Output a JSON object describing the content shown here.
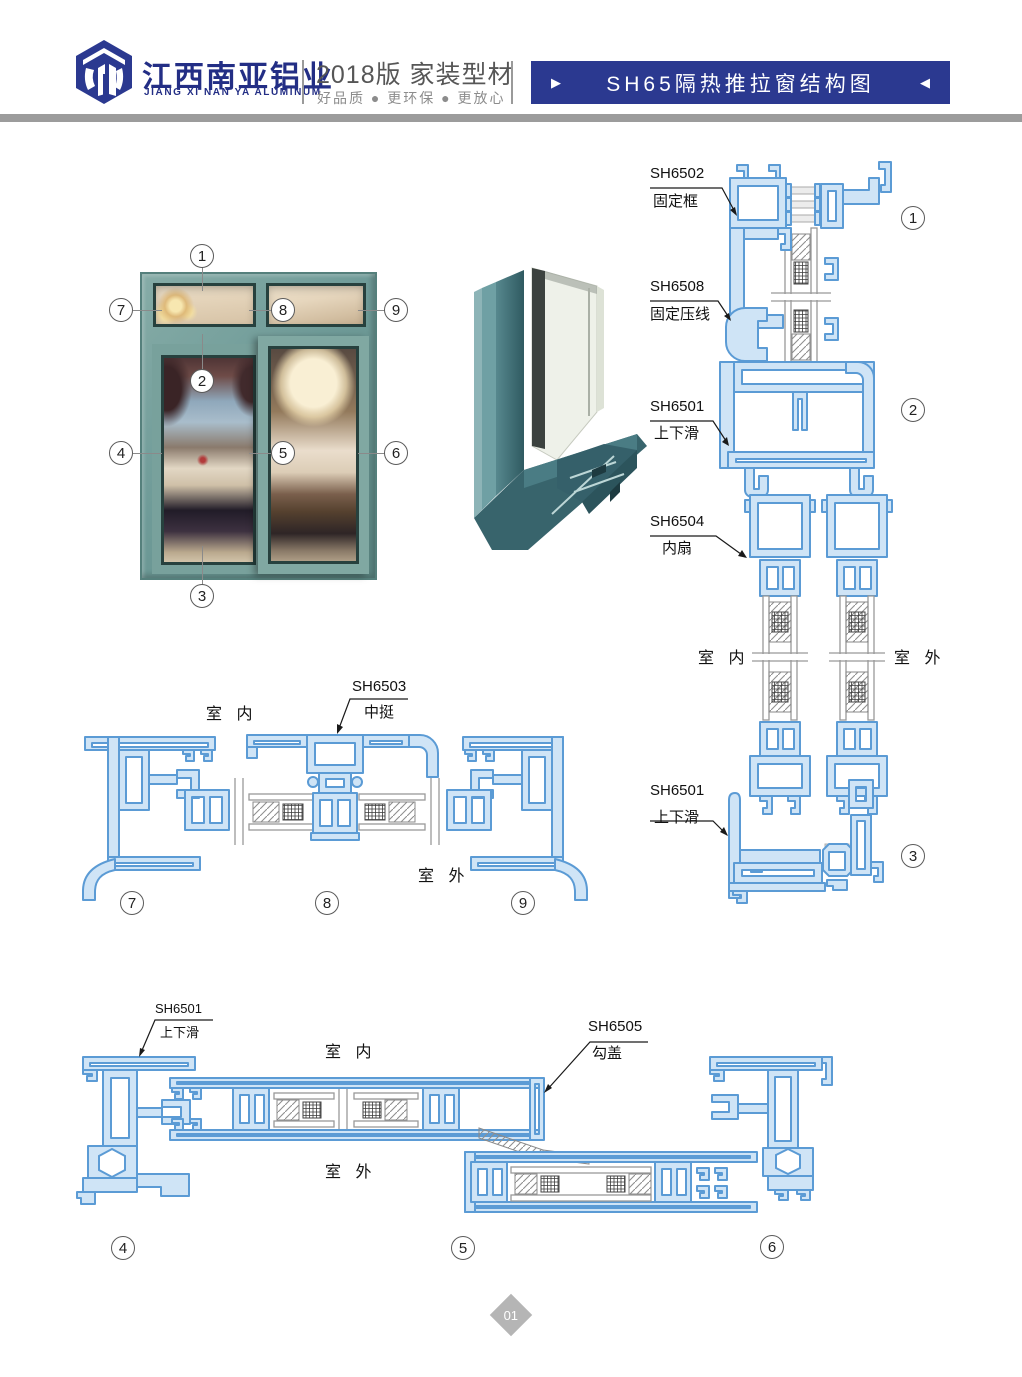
{
  "header": {
    "logo_icon": "hexagon-building-logo",
    "company_cn": "江西南亚铝业",
    "company_en": "JIANG XI NAN YA ALUMINUM",
    "edition": "2018版  家装型材",
    "slogan": "好品质 ● 更环保 ● 更放心",
    "arrow_left": "▶",
    "arrow_right": "◀",
    "title": "SH65隔热推拉窗结构图"
  },
  "page_number": "01",
  "window_callouts": [
    "1",
    "2",
    "3",
    "4",
    "5",
    "6",
    "7",
    "8",
    "9"
  ],
  "section_callouts": {
    "vertical": [
      "1",
      "2",
      "3"
    ],
    "mid_horizontal": [
      "7",
      "8",
      "9"
    ],
    "bottom_horizontal": [
      "4",
      "5",
      "6"
    ]
  },
  "profiles": {
    "sh6502": {
      "code": "SH6502",
      "name": "固定框"
    },
    "sh6508": {
      "code": "SH6508",
      "name": "固定压线"
    },
    "sh6501": {
      "code": "SH6501",
      "name": "上下滑"
    },
    "sh6504": {
      "code": "SH6504",
      "name": "内扇"
    },
    "sh6503": {
      "code": "SH6503",
      "name": "中挺"
    },
    "sh6505": {
      "code": "SH6505",
      "name": "勾盖"
    }
  },
  "position_labels": {
    "indoor": "室 内",
    "outdoor": "室 外"
  },
  "colors": {
    "brand_blue": "#2b3990",
    "profile_line_blue": "#5b9bd5",
    "profile_fill_blue": "#cfe4f6",
    "window_frame_teal": "#6f9b98",
    "divider_gray": "#9c9c9c"
  }
}
